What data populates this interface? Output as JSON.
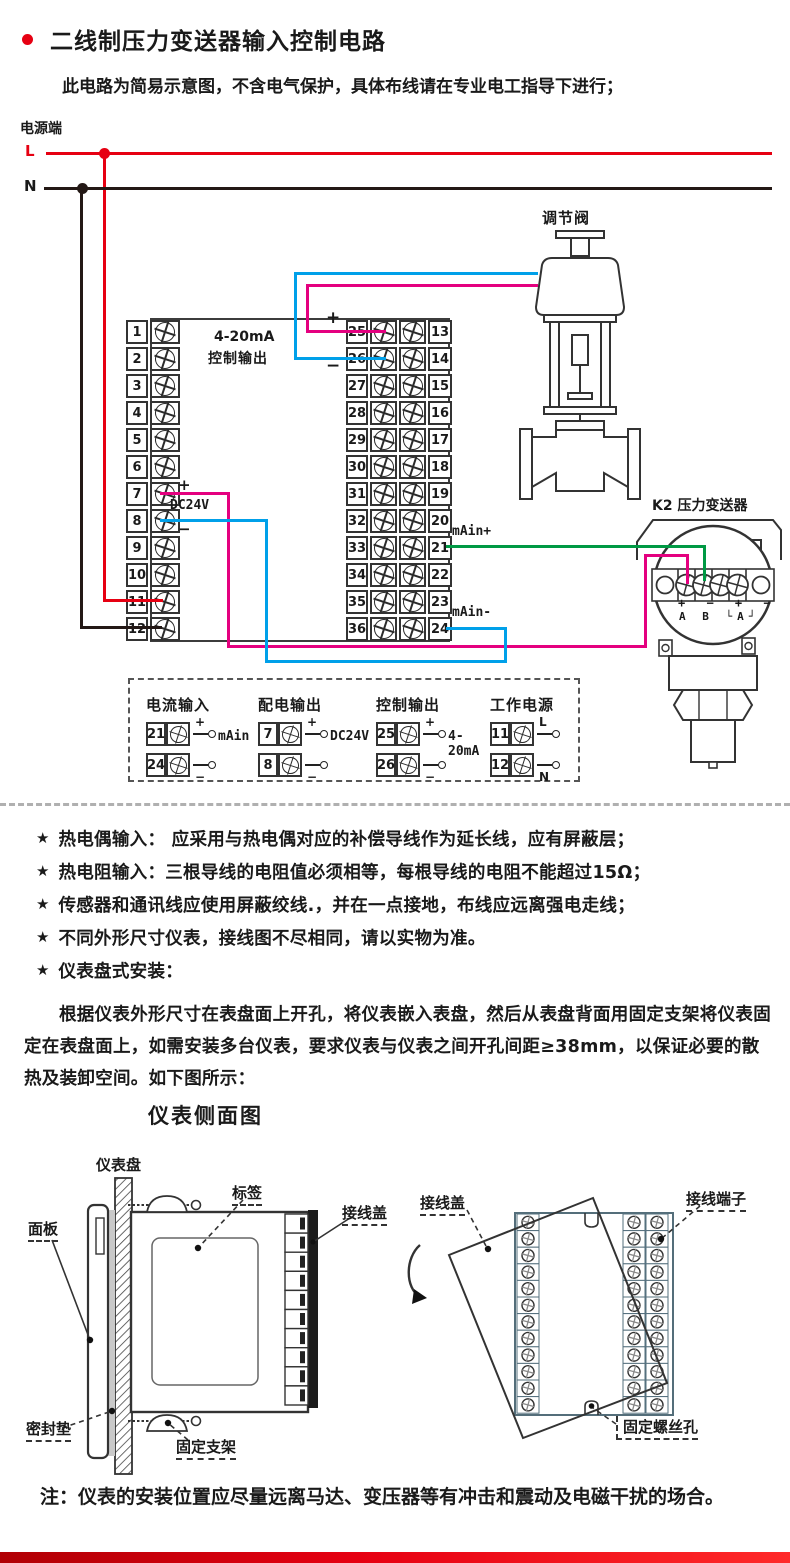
{
  "colors": {
    "accent": "#e60012",
    "wire-live": "#e60012",
    "wire-neutral": "#231815",
    "wire-magenta": "#e4007f",
    "wire-blue": "#00a0e9",
    "wire-green": "#009944"
  },
  "header": {
    "title": "二线制压力变送器输入控制电路",
    "subtitle": "此电路为简易示意图，不含电气保护，具体布线请在专业电工指导下进行；"
  },
  "wiring": {
    "power_label": "电源端",
    "live": "L",
    "neutral": "N",
    "valve_label": "调节阀",
    "transmitter_label": "K2 压力变送器",
    "output_line1": "4-20mA",
    "output_line2": "控制输出",
    "plus": "+",
    "minus": "−",
    "dc24v": "DC24V",
    "main_plus": "mAin+",
    "main_minus": "mAin-",
    "tx_signs": "+ − + −",
    "tx_letters": "A B └A┘",
    "left_terminals": [
      "1",
      "2",
      "3",
      "4",
      "5",
      "6",
      "7",
      "8",
      "9",
      "10",
      "11",
      "12"
    ],
    "right_terminals": [
      {
        "inner": "25",
        "outer": "13"
      },
      {
        "inner": "26",
        "outer": "14"
      },
      {
        "inner": "27",
        "outer": "15"
      },
      {
        "inner": "28",
        "outer": "16"
      },
      {
        "inner": "29",
        "outer": "17"
      },
      {
        "inner": "30",
        "outer": "18"
      },
      {
        "inner": "31",
        "outer": "19"
      },
      {
        "inner": "32",
        "outer": "20"
      },
      {
        "inner": "33",
        "outer": "21"
      },
      {
        "inner": "34",
        "outer": "22"
      },
      {
        "inner": "35",
        "outer": "23"
      },
      {
        "inner": "36",
        "outer": "24"
      }
    ]
  },
  "legend": {
    "groups": [
      {
        "title": "电流输入",
        "rows": [
          {
            "num": "21",
            "tag": "+"
          },
          {
            "num": "24",
            "tag": "−"
          }
        ],
        "label": "mAin"
      },
      {
        "title": "配电输出",
        "rows": [
          {
            "num": "7",
            "tag": "+"
          },
          {
            "num": "8",
            "tag": "−"
          }
        ],
        "label": "DC24V"
      },
      {
        "title": "控制输出",
        "rows": [
          {
            "num": "25",
            "tag": "+"
          },
          {
            "num": "26",
            "tag": "−"
          }
        ],
        "label": "4-20mA"
      },
      {
        "title": "工作电源",
        "rows": [
          {
            "num": "11",
            "tag": "L"
          },
          {
            "num": "12",
            "tag": "N"
          }
        ],
        "label": ""
      }
    ]
  },
  "notes": {
    "marker": "★",
    "items": [
      "热电偶输入： 应采用与热电偶对应的补偿导线作为延长线，应有屏蔽层；",
      "热电阻输入：三根导线的电阻值必须相等，每根导线的电阻不能超过15Ω；",
      "传感器和通讯线应使用屏蔽绞线.，并在一点接地，布线应远离强电走线；",
      "不同外形尺寸仪表，接线图不尽相同，请以实物为准。",
      "仪表盘式安装："
    ]
  },
  "install": {
    "paragraph": "根据仪表外形尺寸在表盘面上开孔，将仪表嵌入表盘，然后从表盘背面用固定支架将仪表固定在表盘面上，如需安装多台仪表，要求仪表与仪表之间开孔间距≥38mm，以保证必要的散热及装卸空间。如下图所示：",
    "heading": "仪表侧面图",
    "labels": {
      "board": "仪表盘",
      "panel": "面板",
      "tag": "标签",
      "cover": "接线盖",
      "cover2": "接线盖",
      "seal": "密封垫",
      "bracket": "固定支架",
      "terminals": "接线端子",
      "screw_hole": "固定螺丝孔"
    },
    "note": "注：仪表的安装位置应尽量远离马达、变压器等有冲击和震动及电磁干扰的场合。"
  }
}
